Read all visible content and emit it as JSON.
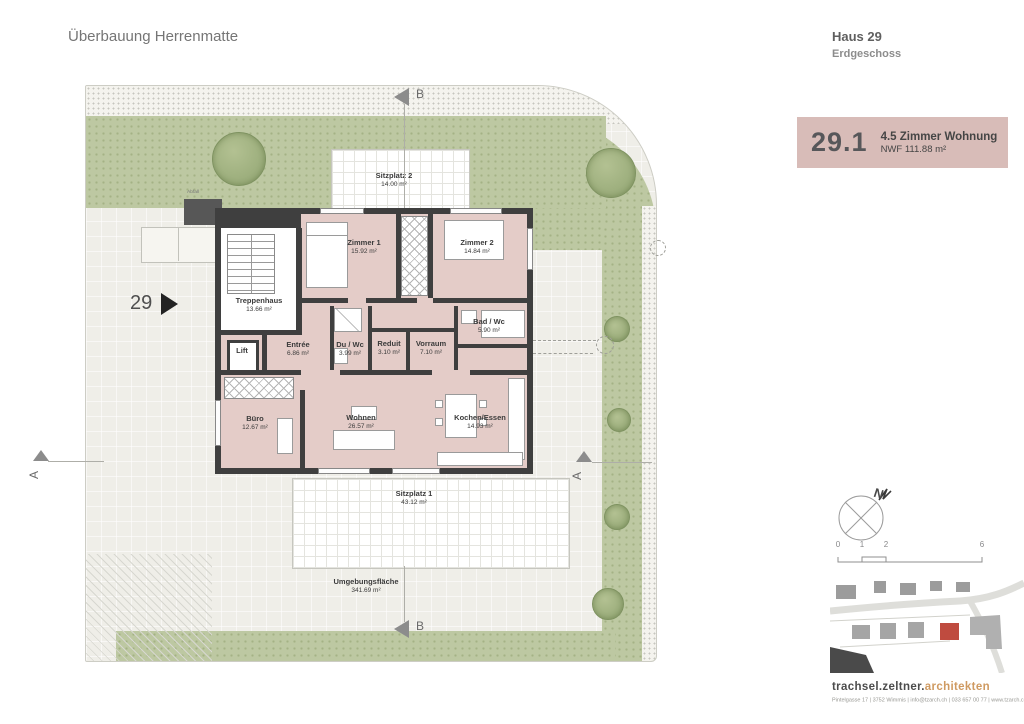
{
  "page": {
    "title": "Überbauung Herrenmatte"
  },
  "header": {
    "house": "Haus 29",
    "floor": "Erdgeschoss"
  },
  "unit_badge": {
    "number": "29.1",
    "type": "4.5 Zimmer Wohnung",
    "area": "NWF 111.88 m²"
  },
  "plan": {
    "entrance_number": "29",
    "rooms": [
      {
        "name": "Zimmer 1",
        "area": "15.92 m²"
      },
      {
        "name": "Zimmer 2",
        "area": "14.84 m²"
      },
      {
        "name": "Treppenhaus",
        "area": "13.66 m²"
      },
      {
        "name": "Lift",
        "area": ""
      },
      {
        "name": "Entrée",
        "area": "6.86 m²"
      },
      {
        "name": "Du / Wc",
        "area": "3.99 m²"
      },
      {
        "name": "Reduit",
        "area": "3.10 m²"
      },
      {
        "name": "Vorraum",
        "area": "7.10 m²"
      },
      {
        "name": "Bad / Wc",
        "area": "5.90 m²"
      },
      {
        "name": "Büro",
        "area": "12.67 m²"
      },
      {
        "name": "Wohnen",
        "area": "26.57 m²"
      },
      {
        "name": "Kochen/Essen",
        "area": "14.93 m²"
      }
    ],
    "outdoor": [
      {
        "name": "Sitzplatz 2",
        "area": "14.00 m²"
      },
      {
        "name": "Sitzplatz 1",
        "area": "43.12 m²"
      },
      {
        "name": "Umgebungsfläche",
        "area": "341.69 m²"
      }
    ],
    "site_labels": {
      "abfall": "Abfall",
      "allgemein": "Allgemein"
    },
    "section_markers": {
      "a": "A",
      "b": "B"
    }
  },
  "legend": {
    "north": "N",
    "scale_ticks": [
      "0",
      "1",
      "2",
      "6"
    ]
  },
  "footer": {
    "brand_primary": "trachsel.zeltner.",
    "brand_secondary": "architekten",
    "address": "Pintelgasse 17 | 3752 Wimmis | info@tzarch.ch | 033 657 00 77 | www.tzarch.ch"
  },
  "colors": {
    "unit_badge_bg": "#d8bcb8",
    "apartment_fill": "#e4ccc8",
    "wall": "#3f3f3f",
    "vegetation": "#bdc8a2",
    "site_map_highlight": "#bf4b3f",
    "brand_accent": "#cf9a61"
  }
}
